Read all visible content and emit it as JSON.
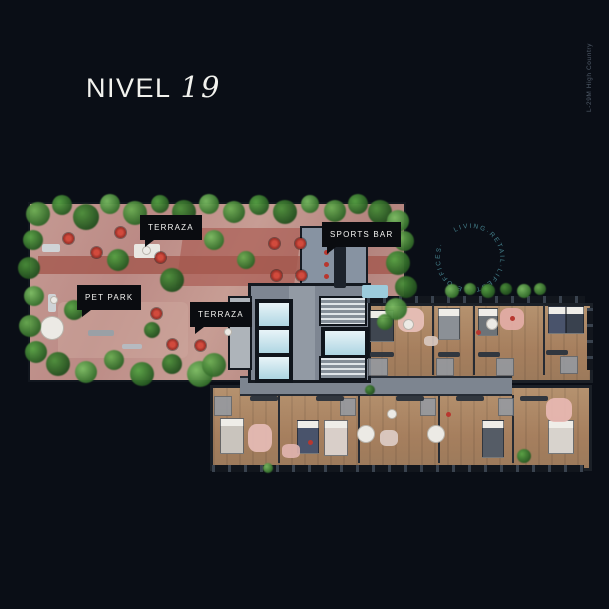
{
  "title": {
    "prefix": "NIVEL",
    "number": "19"
  },
  "credit": "L-29M High Country",
  "badge": {
    "text": "LIVING·RETAIL·LIFESTYLE·OFFICES·",
    "color": "#4a8b97"
  },
  "plan": {
    "labels": [
      {
        "id": "terraza-main",
        "text": "TERRAZA"
      },
      {
        "id": "sports-bar",
        "text": "SPORTS BAR"
      },
      {
        "id": "pet-park",
        "text": "PET PARK"
      },
      {
        "id": "terraza-secondary",
        "text": "TERRAZA"
      }
    ],
    "colors": {
      "background": "#0a0e16",
      "label_background": "#0a0c10",
      "label_text": "#f4f4f2",
      "terrace_floor": "#c2938c",
      "walkway_red": "#a4584e",
      "greenery_green": "#3d7c31",
      "umbrella_red": "#c0392e",
      "wood_floor": "#ab8766",
      "core_gray": "#7e8692",
      "elevator_blue": "#bfe0ea",
      "wall_dark": "#141920",
      "badge_teal": "#4a8b97"
    }
  }
}
